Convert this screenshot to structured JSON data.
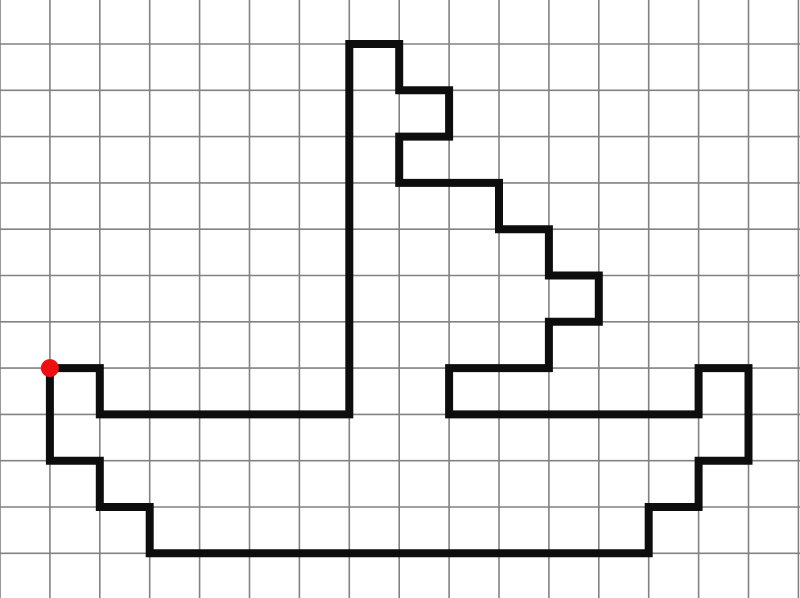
{
  "canvas": {
    "width": 800,
    "height": 598,
    "background_color": "#ffffff",
    "grid": {
      "cols": 16,
      "rows": 11,
      "cell_width": 49.9,
      "cell_height": 46.3,
      "left_offset": 0,
      "top_offset": 44,
      "line_color": "#828282",
      "line_width": 1.6
    },
    "path": {
      "description": "boat-figure-outline",
      "stroke_color": "#0d0d0d",
      "stroke_width": 8,
      "closed": true,
      "points_grid_units": [
        [
          1,
          7
        ],
        [
          2,
          7
        ],
        [
          2,
          8
        ],
        [
          7,
          8
        ],
        [
          7,
          0
        ],
        [
          8,
          0
        ],
        [
          8,
          1
        ],
        [
          9,
          1
        ],
        [
          9,
          2
        ],
        [
          8,
          2
        ],
        [
          8,
          3
        ],
        [
          10,
          3
        ],
        [
          10,
          4
        ],
        [
          11,
          4
        ],
        [
          11,
          5
        ],
        [
          12,
          5
        ],
        [
          12,
          6
        ],
        [
          11,
          6
        ],
        [
          11,
          7
        ],
        [
          9,
          7
        ],
        [
          9,
          8
        ],
        [
          14,
          8
        ],
        [
          14,
          7
        ],
        [
          15,
          7
        ],
        [
          15,
          9
        ],
        [
          14,
          9
        ],
        [
          14,
          10
        ],
        [
          13,
          10
        ],
        [
          13,
          11
        ],
        [
          3,
          11
        ],
        [
          3,
          10
        ],
        [
          2,
          10
        ],
        [
          2,
          9
        ],
        [
          1,
          9
        ],
        [
          1,
          7
        ]
      ]
    },
    "start_marker": {
      "col": 1,
      "row": 7,
      "radius": 9,
      "fill_color": "#ee1010"
    }
  }
}
